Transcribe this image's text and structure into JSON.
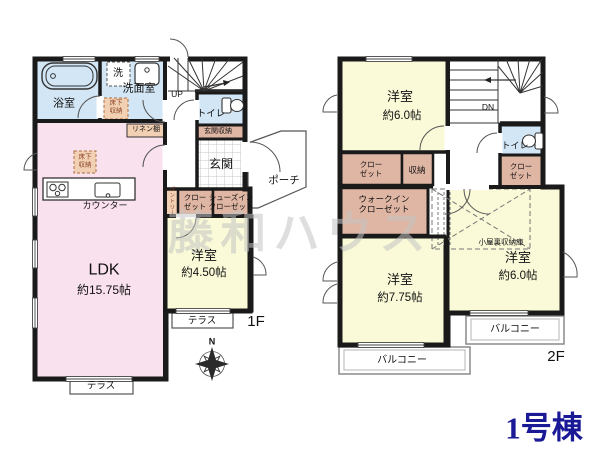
{
  "building_label": "1号棟",
  "watermark": "藤和ハウス",
  "compass": {
    "north": "N"
  },
  "colors": {
    "wall": "#1a1a1a",
    "room_yellow": "#fafad8",
    "ldk_pink": "#f9e1ee",
    "wet_area_blue": "#d2e6f5",
    "closet_tan": "#dfb5a3",
    "storage_tan": "#f2d0b3",
    "accent_navy": "#1a1a96",
    "watermark_gray": "#c3c3c3"
  },
  "floor1": {
    "label": "1F",
    "stairs_up": "UP",
    "bath": "浴室",
    "washer": "洗",
    "washroom": "洗面室",
    "underfloor_storage": "床下\n収納",
    "linen_shelf": "リネン棚",
    "toilet": "トイレ",
    "entrance_storage": "玄関収納",
    "entrance": "玄関",
    "porch": "ポーチ",
    "pantry": "パントリー",
    "closet": "クロー\nゼット",
    "shoes_closet": "シューズイン\nクローゼット",
    "ldk_name": "LDK",
    "ldk_size": "約15.75帖",
    "counter": "カウンター",
    "ldk_underfloor": "床下\n収納",
    "bedroom_name": "洋室",
    "bedroom_size": "約4.50帖",
    "terrace_right": "テラス",
    "terrace_bottom": "テラス"
  },
  "floor2": {
    "label": "2F",
    "stairs_down": "DN",
    "bedroom_tl_name": "洋室",
    "bedroom_tl_size": "約6.0帖",
    "toilet": "トイレ",
    "closet_right": "クロー\nゼット",
    "closet_left": "クロー\nゼット",
    "storage": "収納",
    "walkin_closet": "ウォークイン\nクローゼット",
    "attic_storage": "小屋裏収納庫",
    "bedroom_bottom_name": "洋室",
    "bedroom_bottom_size": "約7.75帖",
    "bedroom_br_name": "洋室",
    "bedroom_br_size": "約6.0帖",
    "balcony_left": "バルコニー",
    "balcony_right": "バルコニー"
  }
}
